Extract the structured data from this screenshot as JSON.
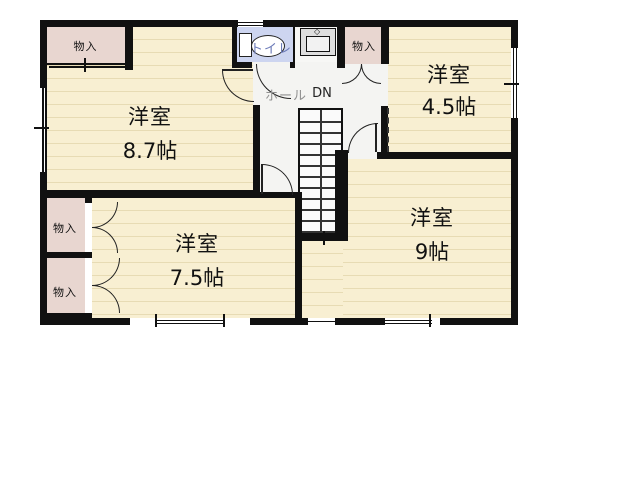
{
  "floorplan": {
    "rooms": [
      {
        "name": "洋室",
        "size": "8.7帖"
      },
      {
        "name": "洋室",
        "size": "4.5帖"
      },
      {
        "name": "洋室",
        "size": "9帖"
      },
      {
        "name": "洋室",
        "size": "7.5帖"
      }
    ],
    "closets": [
      {
        "label": "物入"
      },
      {
        "label": "物入"
      },
      {
        "label": "物入"
      },
      {
        "label": "物入"
      }
    ],
    "toilet": {
      "label": "トイレ"
    },
    "hall": {
      "label": "ホール",
      "stairs": "DN"
    },
    "colors": {
      "floor": "#f8efd2",
      "floor_stripe": "#e7dbb4",
      "closet": "#e8d6d0",
      "toilet": "#cdd5f0",
      "hall": "#f4f4f2",
      "wall": "#111111",
      "toilet_text": "#6b7ab8",
      "hall_text": "#909090"
    }
  }
}
